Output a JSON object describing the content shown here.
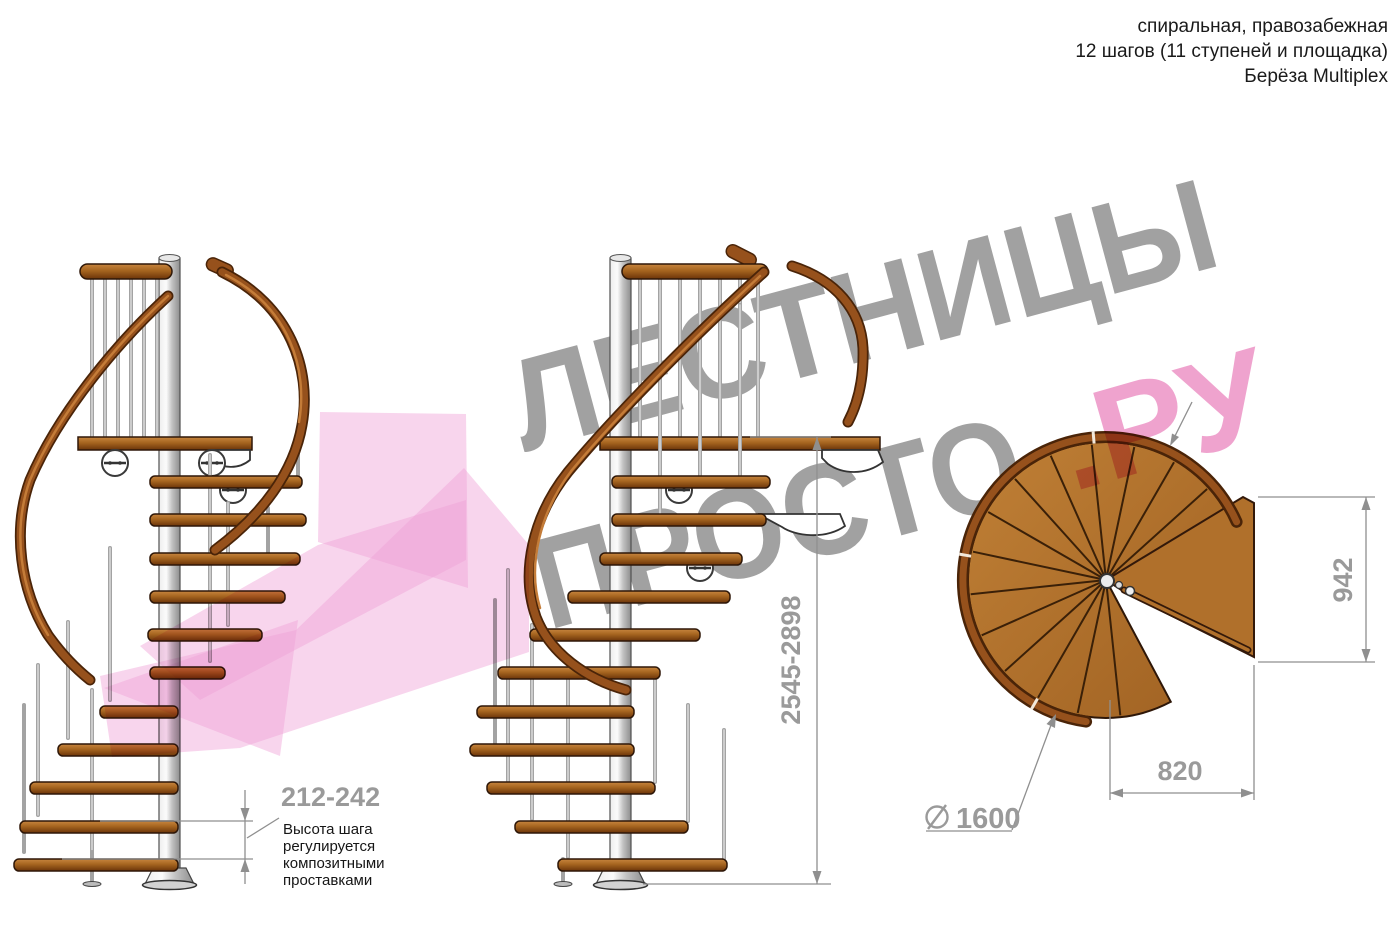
{
  "header": {
    "line1": "спиральная, правозабежная",
    "line2": "12 шагов (11 ступеней и площадка)",
    "line3": "Берёза Multiplex"
  },
  "watermark": {
    "word_top": "ЛЕСТНИЦЫ",
    "word_bottom": "ПРОСТО",
    "suffix": ".РУ",
    "gray_color": "#a1a1a1",
    "pink_color": "#f0a2d6"
  },
  "dimensions": {
    "step_height": "212-242",
    "step_note_lines": [
      "Высота шага",
      "регулируется",
      "композитными",
      "проставками"
    ],
    "total_height": "2545-2898",
    "landing_depth": "942",
    "landing_width": "820",
    "diameter_symbol": "⌀",
    "diameter_value": "1600"
  },
  "colors": {
    "wood_light": "#c8863f",
    "wood_mid": "#a5641f",
    "wood_dark": "#6b3409",
    "metal_pole": "#c9c9c9",
    "dimension_gray": "#9a9a9a",
    "text_black": "#1a1a1a"
  }
}
